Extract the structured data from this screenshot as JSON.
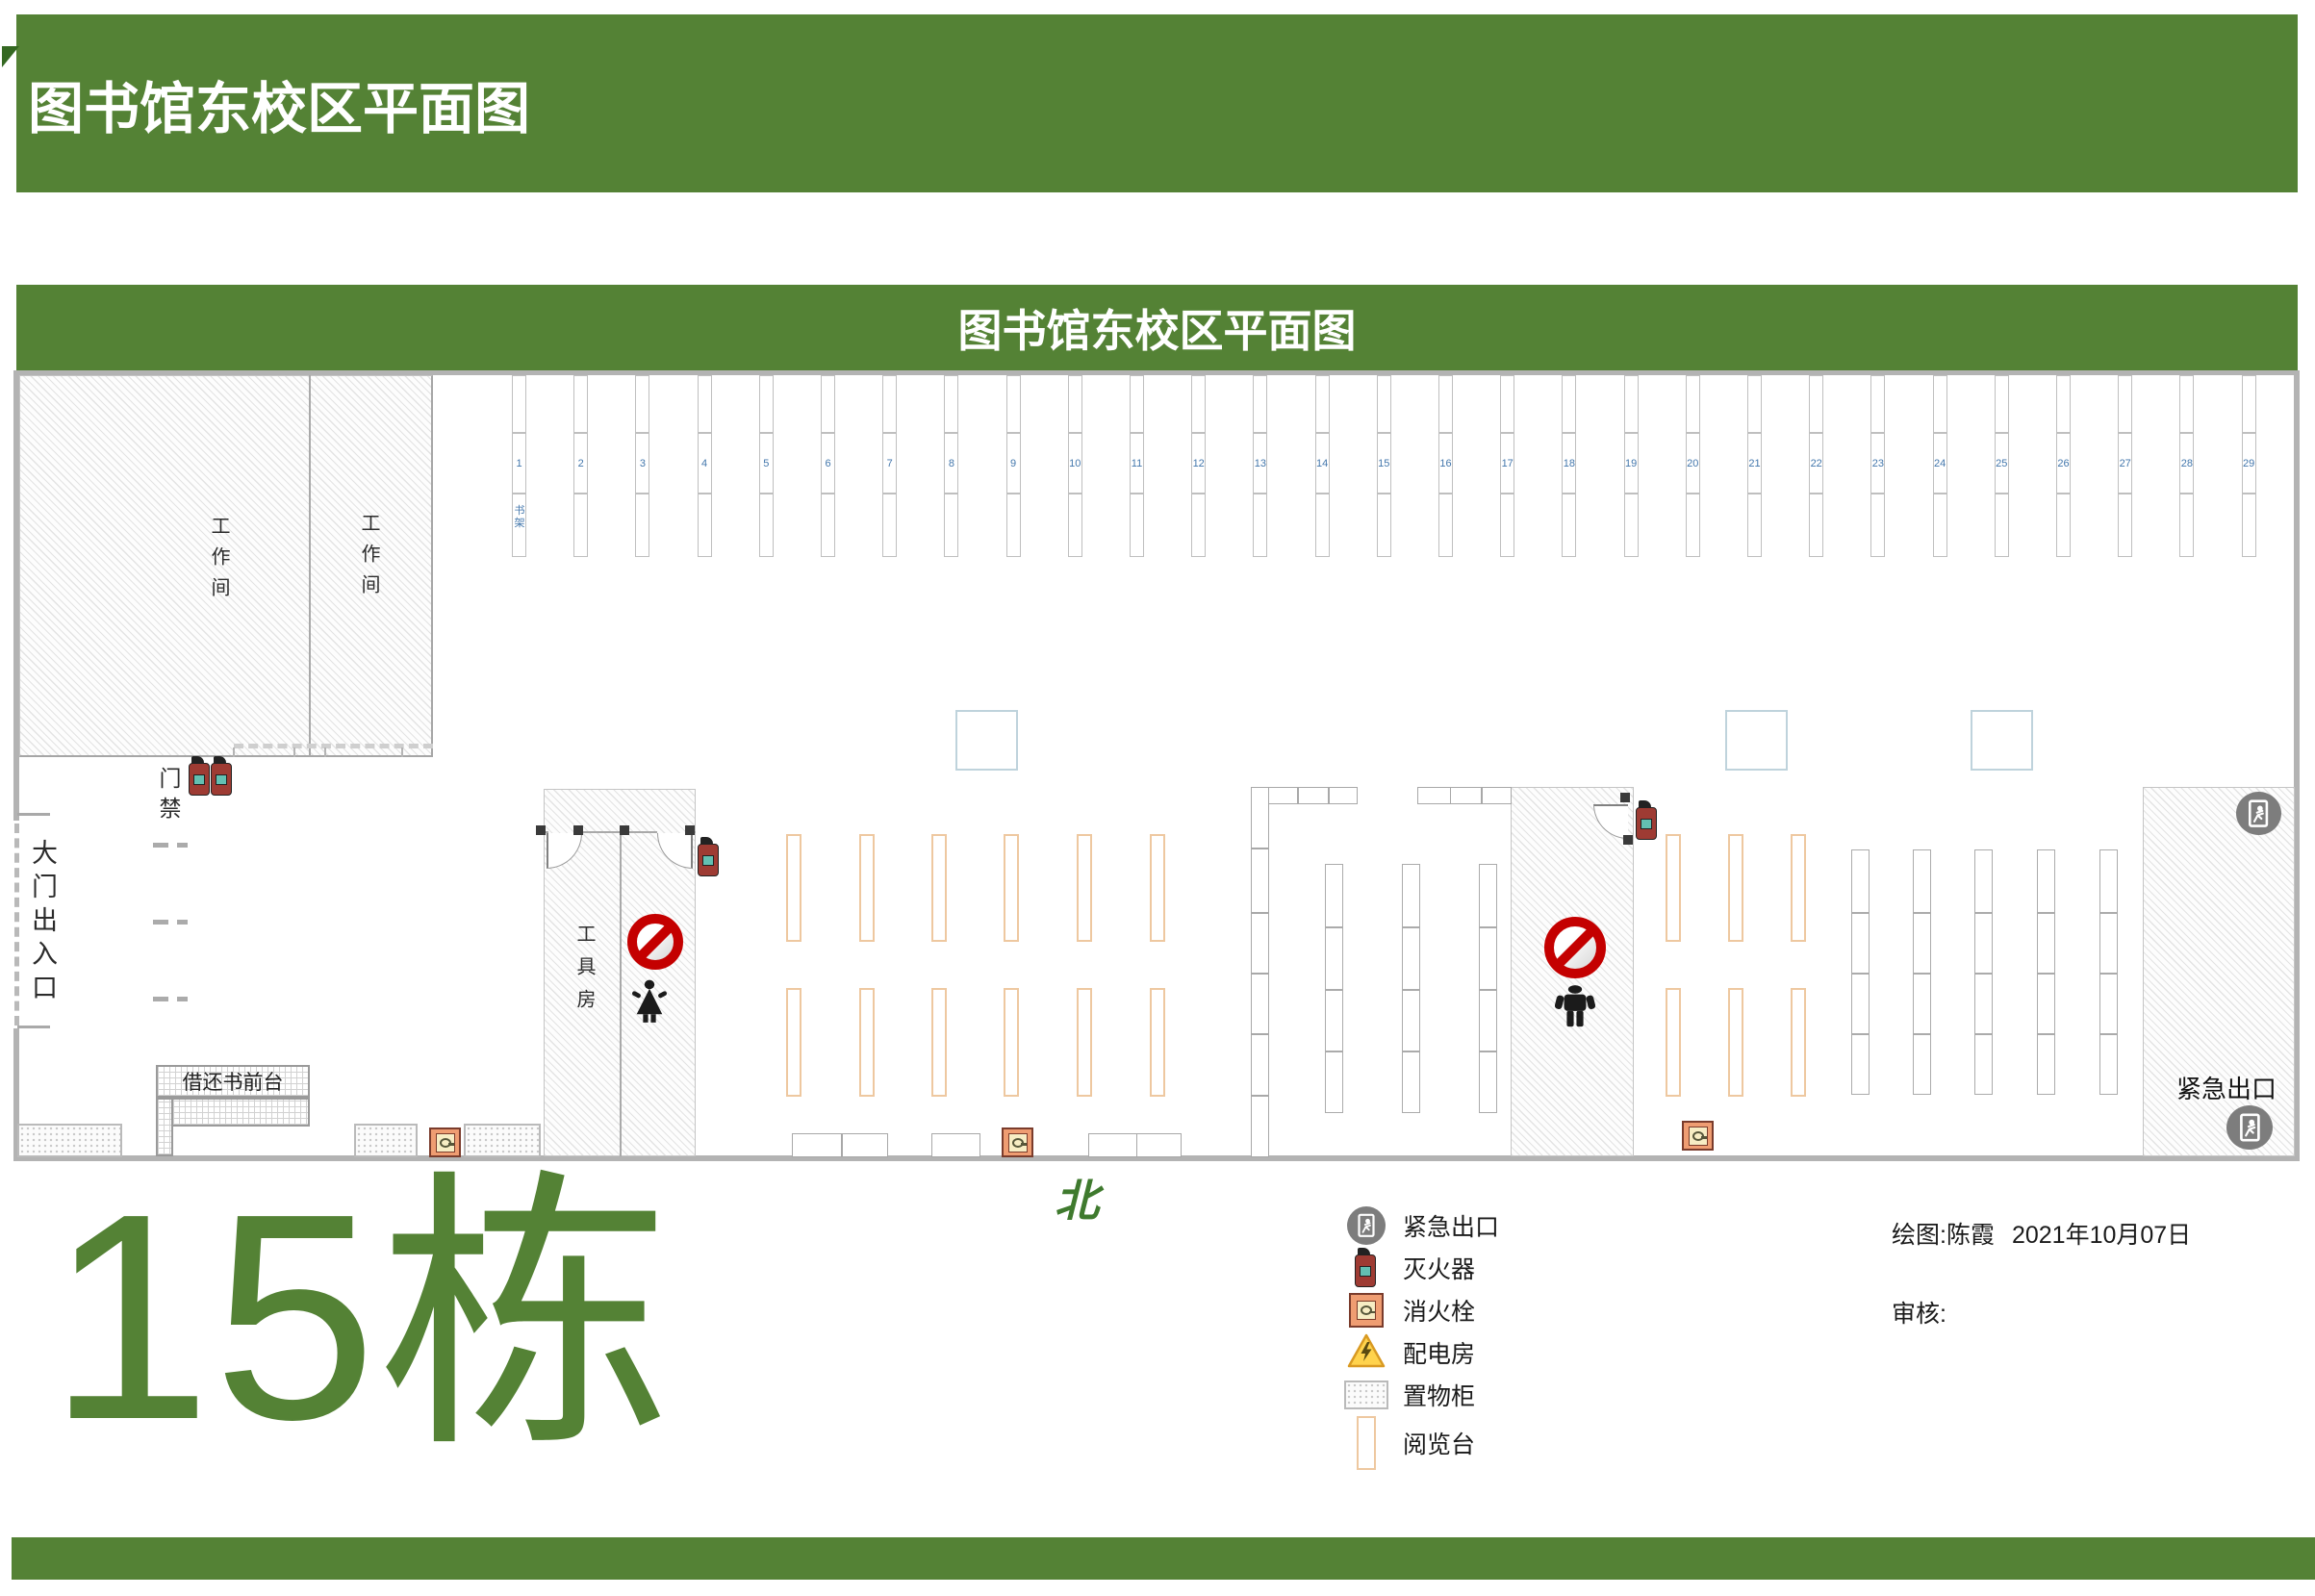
{
  "header": {
    "title": "图书馆东校区平面图"
  },
  "plan": {
    "title": "图书馆东校区平面图",
    "labels": {
      "workroom": "工作间",
      "entrance": "大门出入口",
      "access_control": "门禁",
      "tool_room": "工具房",
      "borrow_desk": "借还书前台",
      "emergency_exit": "紧急出口",
      "shelf": "书架"
    },
    "shelf_numbers": [
      1,
      2,
      3,
      4,
      5,
      6,
      7,
      8,
      9,
      10,
      11,
      12,
      13,
      14,
      15,
      16,
      17,
      18,
      19,
      20,
      21,
      22,
      23,
      24,
      25,
      26,
      27,
      28,
      29
    ]
  },
  "legend": {
    "items": [
      {
        "icon": "emergency-exit-icon",
        "label": "紧急出口"
      },
      {
        "icon": "fire-extinguisher-icon",
        "label": "灭火器"
      },
      {
        "icon": "fire-hydrant-icon",
        "label": "消火栓"
      },
      {
        "icon": "power-room-icon",
        "label": "配电房"
      },
      {
        "icon": "cabinet-icon",
        "label": "置物柜"
      },
      {
        "icon": "reading-desk-icon",
        "label": "阅览台"
      }
    ]
  },
  "credits": {
    "drawn_by": "绘图:陈霞",
    "date": "2021年10月07日",
    "review_label": "审核:"
  },
  "footer": {
    "north_label": "北",
    "building_label": "15栋"
  },
  "colors": {
    "banner_green": "#548235",
    "shelf_number_blue": "#4377ac",
    "no_entry_red": "#c40000",
    "reading_desk_orange": "#eec8a0",
    "wall_gray": "#b3b3b3",
    "hydrant_orange": "#ef9d72",
    "exit_icon_gray": "#7d7d7d"
  }
}
